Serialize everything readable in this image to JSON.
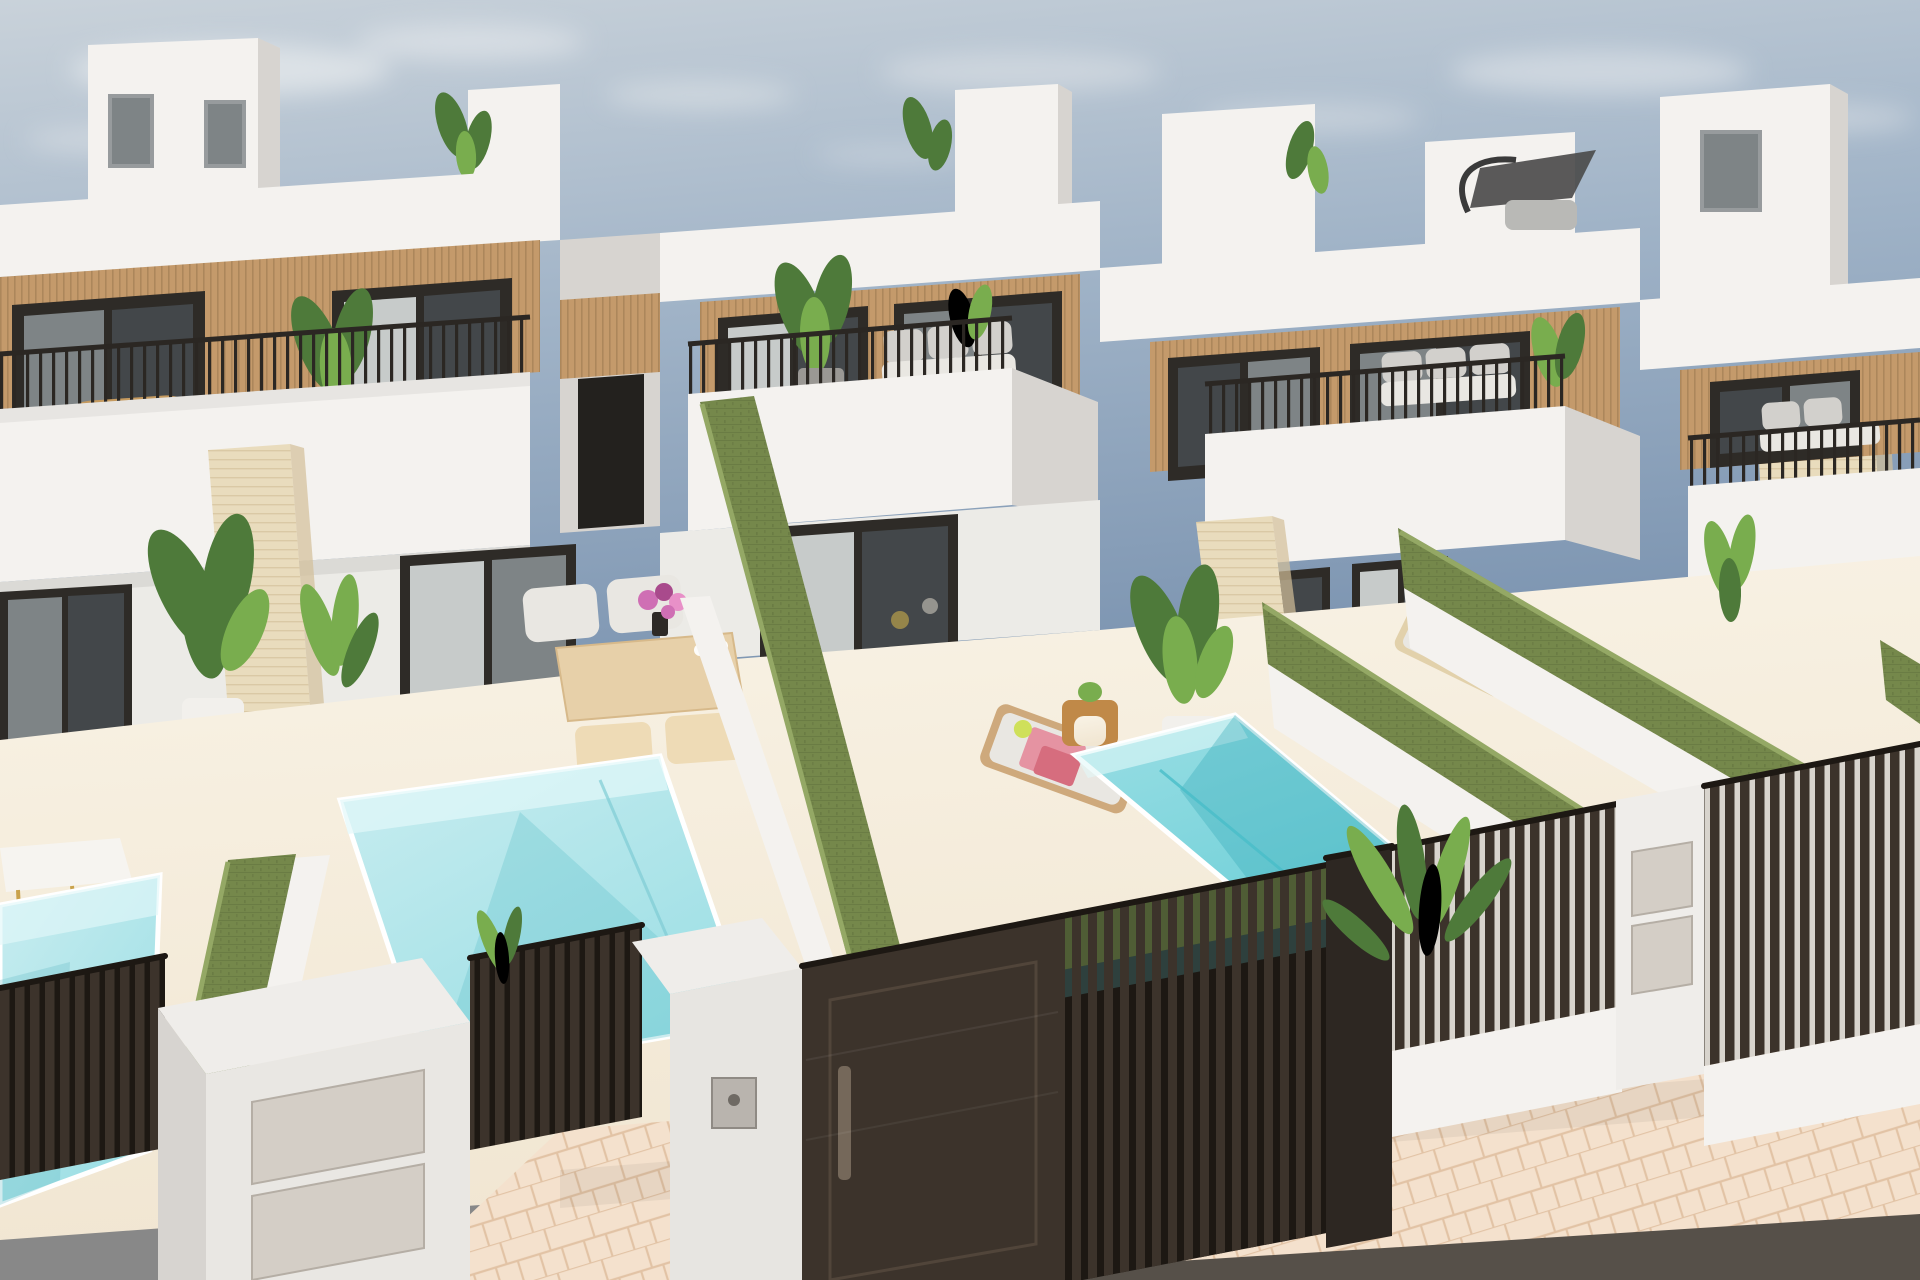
{
  "scene": {
    "type": "3d-architectural-render",
    "description": "Sunny aerial three-quarter rendering of a row of modern white two-storey holiday villas with wood-slat facade accents, black-framed glass doors, balconies with thin black railings, cream travertine pillars, private patios with small turquoise plunge pools, green privacy hedge walls between gardens, dark slatted street fences with entry gates and letterbox pillars, a beige paved sidewalk and asphalt road in the foreground.",
    "sky": "light blue with thin soft clouds",
    "villas_visible": 5,
    "pools_visible": 3,
    "hedge_walls_visible": 5,
    "balconies_with_railings": 4,
    "street_elements": [
      "dark slatted fence",
      "solid entry gate",
      "slatted driveway gate",
      "white letterbox pillar",
      "keypad pillar",
      "letterbox wall",
      "paved sidewalk",
      "asphalt road edge"
    ],
    "furniture": [
      "rattan balcony chairs",
      "white balcony sofas",
      "outdoor dining table with chairs and stools",
      "sun lounger with pink towels",
      "wooden side table",
      "pale sun lounger",
      "gold-leg side table"
    ],
    "plants": [
      "banana plants",
      "parlor palms",
      "potted palms",
      "roof terrace plants",
      "pink flower bouquet"
    ],
    "rooftop_accessory": "dark cantilever parasol"
  },
  "palette": {
    "sky-top": "#c9d2da",
    "sky-mid": "#a0b3c7",
    "sky-deep": "#7e96b2",
    "cloud": "#e6e9ec",
    "wall-lit": "#f4f2ef",
    "wall-light": "#ecebe7",
    "wall-shade": "#d7d4d0",
    "wall-dark": "#c3c0bb",
    "pillar-white": "#efedea",
    "wood": "#c49a6b",
    "wood-dark": "#9d7a50",
    "frame-dark": "#2e2b27",
    "glass-dark": "#43474a",
    "glass-mid": "#7e8486",
    "glass-light": "#c7cbca",
    "travertine": "#e9dcbd",
    "travertine-line": "#d3bf99",
    "hedge-face": "#75884b",
    "hedge-top": "#94a865",
    "hedge-dark": "#5c6f3e",
    "pool-light": "#c9edf0",
    "pool-mid": "#9adee4",
    "pool-deep": "#6fd0d8",
    "pool-wall": "#e2f8f9",
    "patio": "#f1e6d2",
    "patio-light": "#f9f3e6",
    "paver": "#f4e1cd",
    "paver-line": "#e2c3a5",
    "road": "#565049",
    "fence": "#3c332b",
    "fence-dark": "#1d1813",
    "fence-gap": "#d8d4cd",
    "fence-post": "#2d2722",
    "metal-panel": "#d4cec6",
    "metal-edge": "#b5aea5",
    "rattan": "#c59a5f",
    "cushion": "#e9e7e2",
    "sofa": "#d2d0cc",
    "lounger-wood": "#cea97c",
    "lounger-pale": "#e2d1ab",
    "towel-pink": "#e593a2",
    "towel-red": "#d66d7e",
    "lime": "#cfe05a",
    "flower": "#cf6fb4",
    "flower-dark": "#a94a8c",
    "plant": "#4e7a3a",
    "plant-light": "#79ad4e",
    "plant-pale": "#a9c86a",
    "pot-white": "#f2f0ec",
    "table-wood": "#e7d0a9",
    "stool-wood": "#eedbb6",
    "gold": "#c9a24b",
    "umbrella": "#4c4c4c"
  }
}
